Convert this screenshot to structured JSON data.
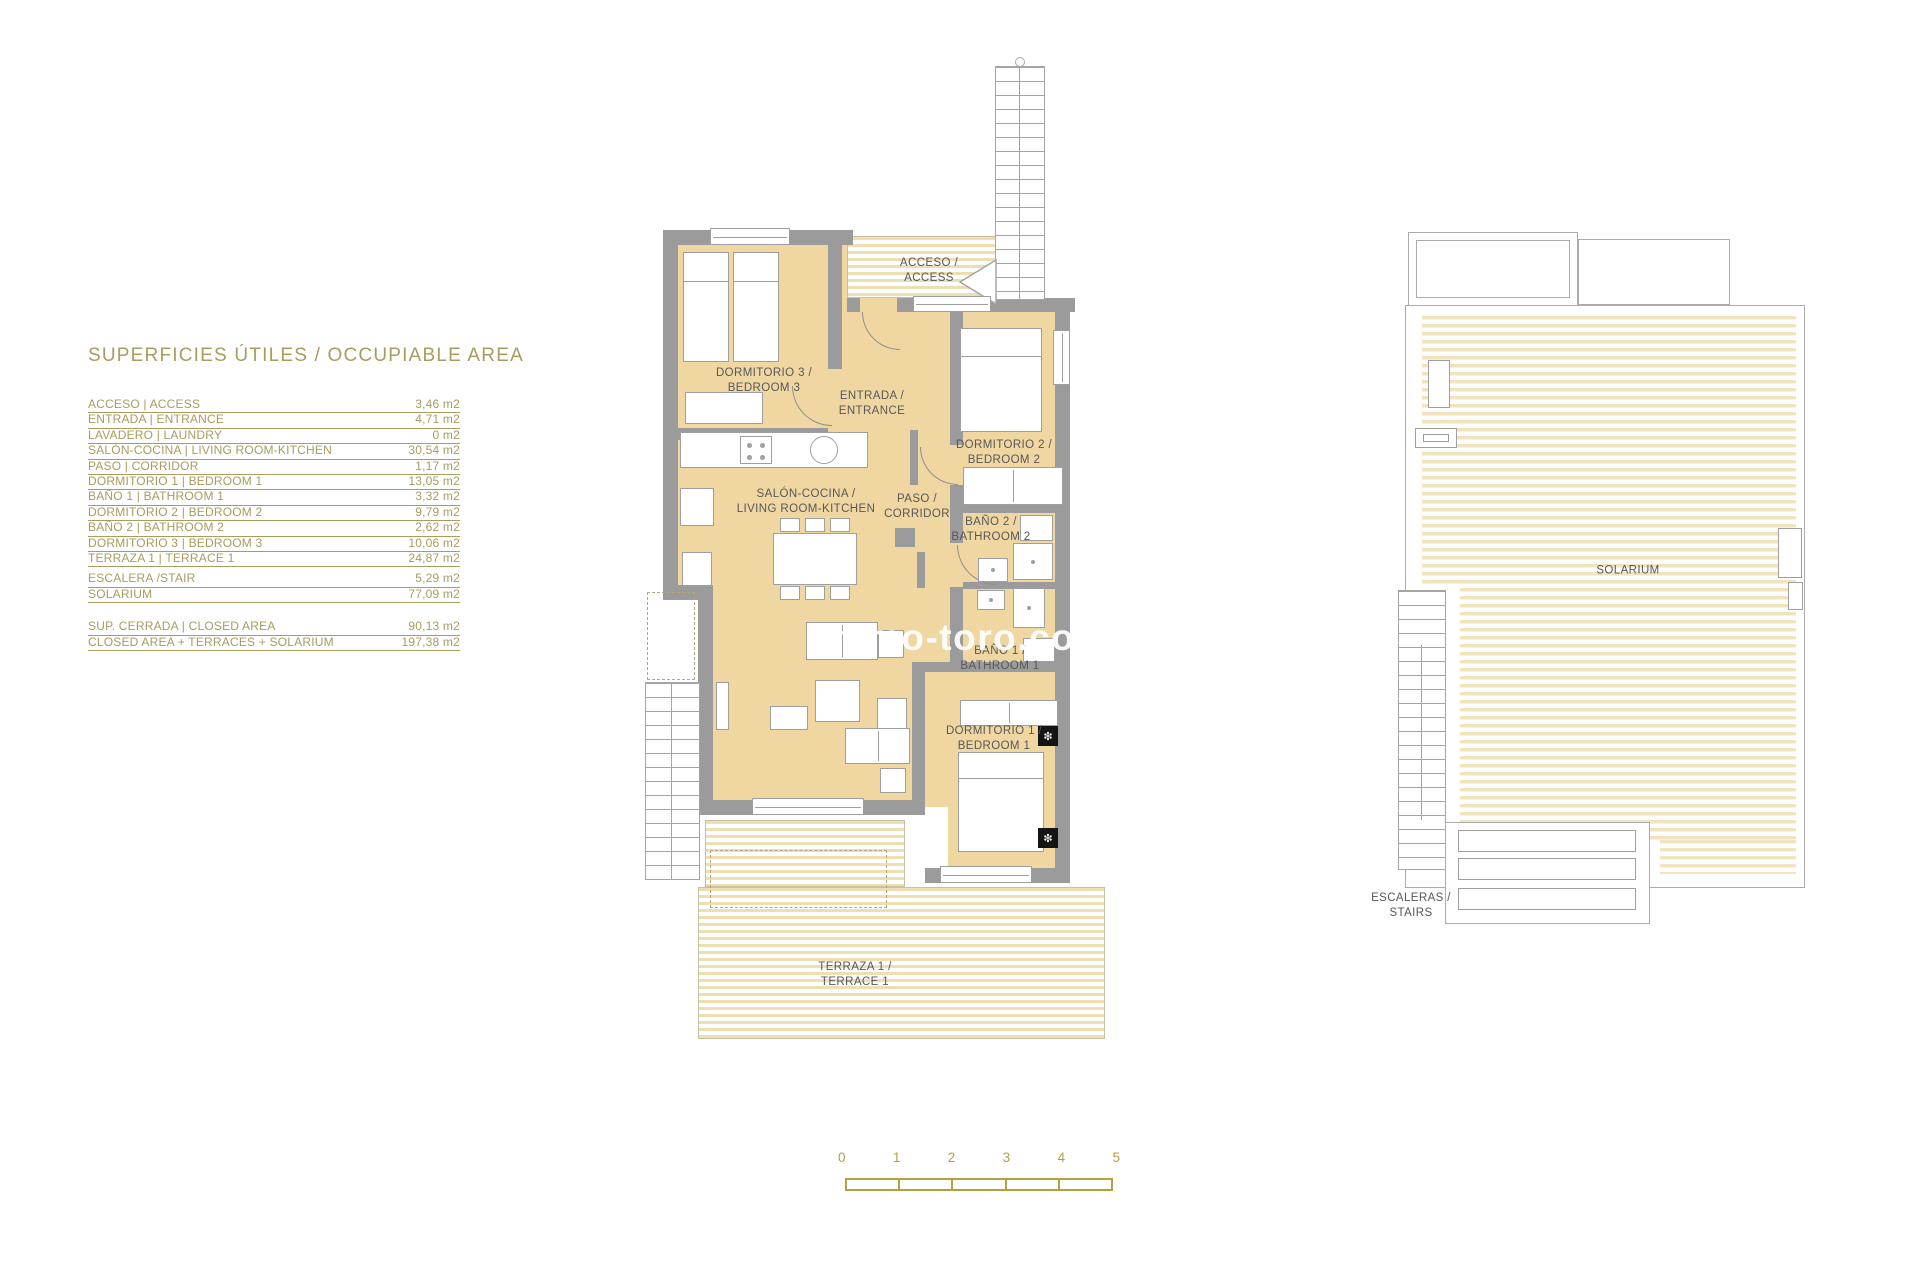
{
  "title": "SUPERFICIES ÚTILES / OCCUPIABLE AREA",
  "area_table": {
    "main_rows": [
      {
        "label": "ACCESO | ACCESS",
        "value": "3,46 m2"
      },
      {
        "label": "ENTRADA | ENTRANCE",
        "value": "4,71 m2"
      },
      {
        "label": "LAVADERO | LAUNDRY",
        "value": "0 m2"
      },
      {
        "label": "SALÓN-COCINA | LIVING ROOM-KITCHEN",
        "value": "30,54 m2"
      },
      {
        "label": "PASO | CORRIDOR",
        "value": "1,17 m2"
      },
      {
        "label": "DORMITORIO 1 | BEDROOM 1",
        "value": "13,05 m2"
      },
      {
        "label": "BAÑO 1 | BATHROOM 1",
        "value": "3,32 m2"
      },
      {
        "label": "DORMITORIO 2 | BEDROOM 2",
        "value": "9,79 m2"
      },
      {
        "label": "BAÑO 2 | BATHROOM 2",
        "value": "2,62 m2"
      },
      {
        "label": "DORMITORIO 3 | BEDROOM 3",
        "value": "10,06 m2"
      },
      {
        "label": "TERRAZA 1 | TERRACE 1",
        "value": "24,87 m2"
      }
    ],
    "extra_rows": [
      {
        "label": "ESCALERA /STAIR",
        "value": "5,29 m2"
      },
      {
        "label": "SOLARIUM",
        "value": "77,09 m2"
      }
    ],
    "total_rows": [
      {
        "label": "SUP. CERRADA | CLOSED AREA",
        "value": "90,13 m2"
      },
      {
        "label": "CLOSED AREA + TERRACES + SOLARIUM",
        "value": "197,38 m2"
      }
    ]
  },
  "floor_plan": {
    "rooms": {
      "acceso": "ACCESO /\nACCESS",
      "dormitorio3": "DORMITORIO 3 /\nBEDROOM 3",
      "entrada": "ENTRADA /\nENTRANCE",
      "dormitorio2": "DORMITORIO 2 /\nBEDROOM 2",
      "salon": "SALÓN-COCINA /\nLIVING ROOM-KITCHEN",
      "paso": "PASO /\nCORRIDOR",
      "bano2": "BAÑO 2 /\nBATHROOM 2",
      "bano1": "BAÑO 1 /\nBATHROOM 1",
      "dormitorio1": "DORMITORIO 1 /\nBEDROOM 1",
      "terraza": "TERRAZA 1 /\nTERRACE 1"
    }
  },
  "roof_plan": {
    "solarium": "SOLARIUM",
    "escaleras": "ESCALERAS /\nSTAIRS"
  },
  "watermark": "immo-toro.co",
  "scale_bar": {
    "labels": [
      "0",
      "1",
      "2",
      "3",
      "4",
      "5"
    ]
  },
  "colors": {
    "accent_olive": "#a89c5e",
    "scale_gold": "#b5a041",
    "wall_gray": "#9b9b9b",
    "floor_tan": "#f0d7a2",
    "stripe_tan": "#eddfb2",
    "label_gray": "#57575a"
  }
}
